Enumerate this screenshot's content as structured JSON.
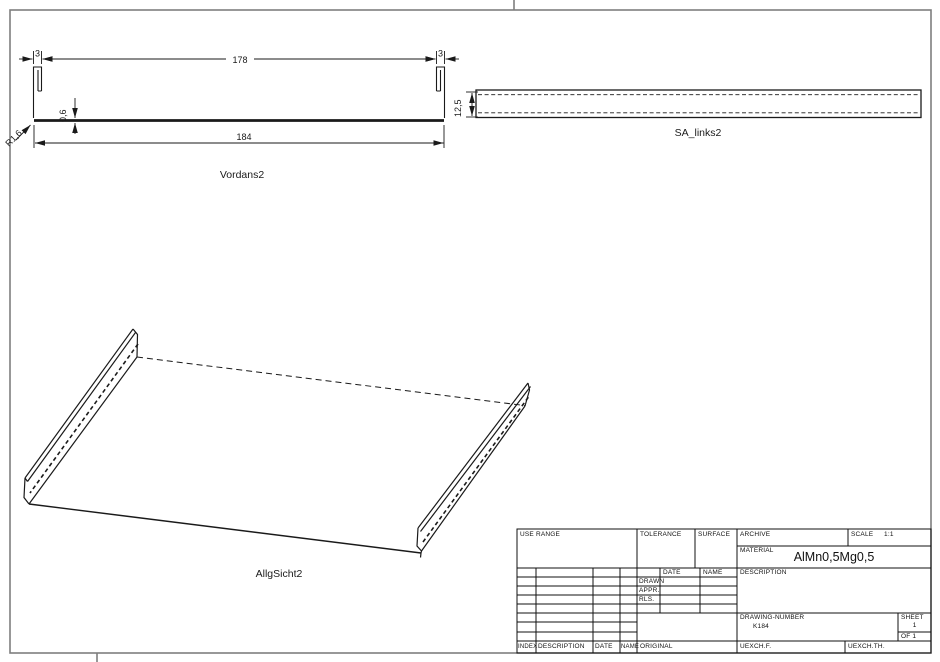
{
  "title_block": {
    "use_range_label": "USE RANGE",
    "tolerance_label": "TOLERANCE",
    "surface_label": "SURFACE",
    "archive_label": "ARCHIVE",
    "scale_label": "SCALE",
    "scale_value": "1:1",
    "material_label": "MATERIAL",
    "material_value": "AlMn0,5Mg0,5",
    "date_header": "DATE",
    "name_header": "NAME",
    "drawn_label": "DRAWN",
    "appr_label": "APPR.",
    "rls_label": "RLS.",
    "description_label": "DESCRIPTION",
    "drawing_number_label": "DRAWING-NUMBER",
    "drawing_number_value": "K184",
    "sheet_label": "SHEET",
    "sheet_number": "1",
    "of_label": "OF 1",
    "index_col": "INDEX",
    "description_col": "DESCRIPTION",
    "date_col": "DATE",
    "name_col": "NAME",
    "original_label": "ORIGINAL",
    "uexch_f_label": "UEXCH.F.",
    "uexch_th_label": "UEXCH.TH."
  },
  "views": {
    "front": {
      "label": "Vordans2",
      "dim_flange_left": "3",
      "dim_width_inner": "178",
      "dim_flange_right": "3",
      "dim_width_overall": "184",
      "dim_thickness": "0,6",
      "dim_radius": "R1,6"
    },
    "side": {
      "label": "SA_links2",
      "dim_height": "12,5"
    },
    "iso": {
      "label": "AllgSicht2"
    }
  },
  "colors": {
    "line": "#1a1a1a",
    "frame": "#7e7e7e",
    "title_lines": "#111111"
  }
}
